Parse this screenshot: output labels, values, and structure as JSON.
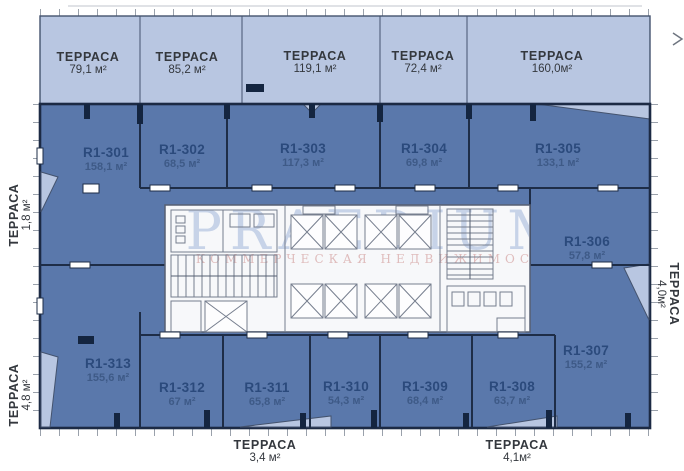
{
  "watermark": {
    "brand": "PRAEDIUM",
    "subtitle": "КОММЕРЧЕСКАЯ НЕДВИЖИМОСТЬ"
  },
  "top_terraces": [
    {
      "label": "ТЕРРАСА",
      "area": "79,1 м²"
    },
    {
      "label": "ТЕРРАСА",
      "area": "85,2 м²"
    },
    {
      "label": "ТЕРРАСА",
      "area": "119,1 м²"
    },
    {
      "label": "ТЕРРАСА",
      "area": "72,4 м²"
    },
    {
      "label": "ТЕРРАСА",
      "area": "160,0м²"
    }
  ],
  "edge_terraces": {
    "left_upper": {
      "label": "ТЕРРАСА",
      "area": "1,8 м²"
    },
    "left_lower": {
      "label": "ТЕРРАСА",
      "area": "4,8 м²"
    },
    "right": {
      "label": "ТЕРРАСА",
      "area": "4,0м²"
    },
    "bottom_left": {
      "label": "ТЕРРАСА",
      "area": "3,4 м²"
    },
    "bottom_right": {
      "label": "ТЕРРАСА",
      "area": "4,1м²"
    }
  },
  "units": [
    {
      "id": "R1-301",
      "area": "158,1 м²"
    },
    {
      "id": "R1-302",
      "area": "68,5 м²"
    },
    {
      "id": "R1-303",
      "area": "117,3 м²"
    },
    {
      "id": "R1-304",
      "area": "69,8 м²"
    },
    {
      "id": "R1-305",
      "area": "133,1 м²"
    },
    {
      "id": "R1-306",
      "area": "57,8 м²"
    },
    {
      "id": "R1-307",
      "area": "155,2 м²"
    },
    {
      "id": "R1-308",
      "area": "63,7 м²"
    },
    {
      "id": "R1-309",
      "area": "68,4 м²"
    },
    {
      "id": "R1-310",
      "area": "54,3 м²"
    },
    {
      "id": "R1-311",
      "area": "65,8 м²"
    },
    {
      "id": "R1-312",
      "area": "67 м²"
    },
    {
      "id": "R1-313",
      "area": "155,6 м²"
    }
  ],
  "colors": {
    "terrace_fill": "#b8c6e1",
    "unit_fill": "#5a78ab",
    "wall_dark": "#1c2a44",
    "core_fill": "#f7f8fa",
    "unit_label": "#2b4a7c",
    "watermark_blue": "#bccbe4",
    "watermark_pink": "#ddb6b6"
  }
}
